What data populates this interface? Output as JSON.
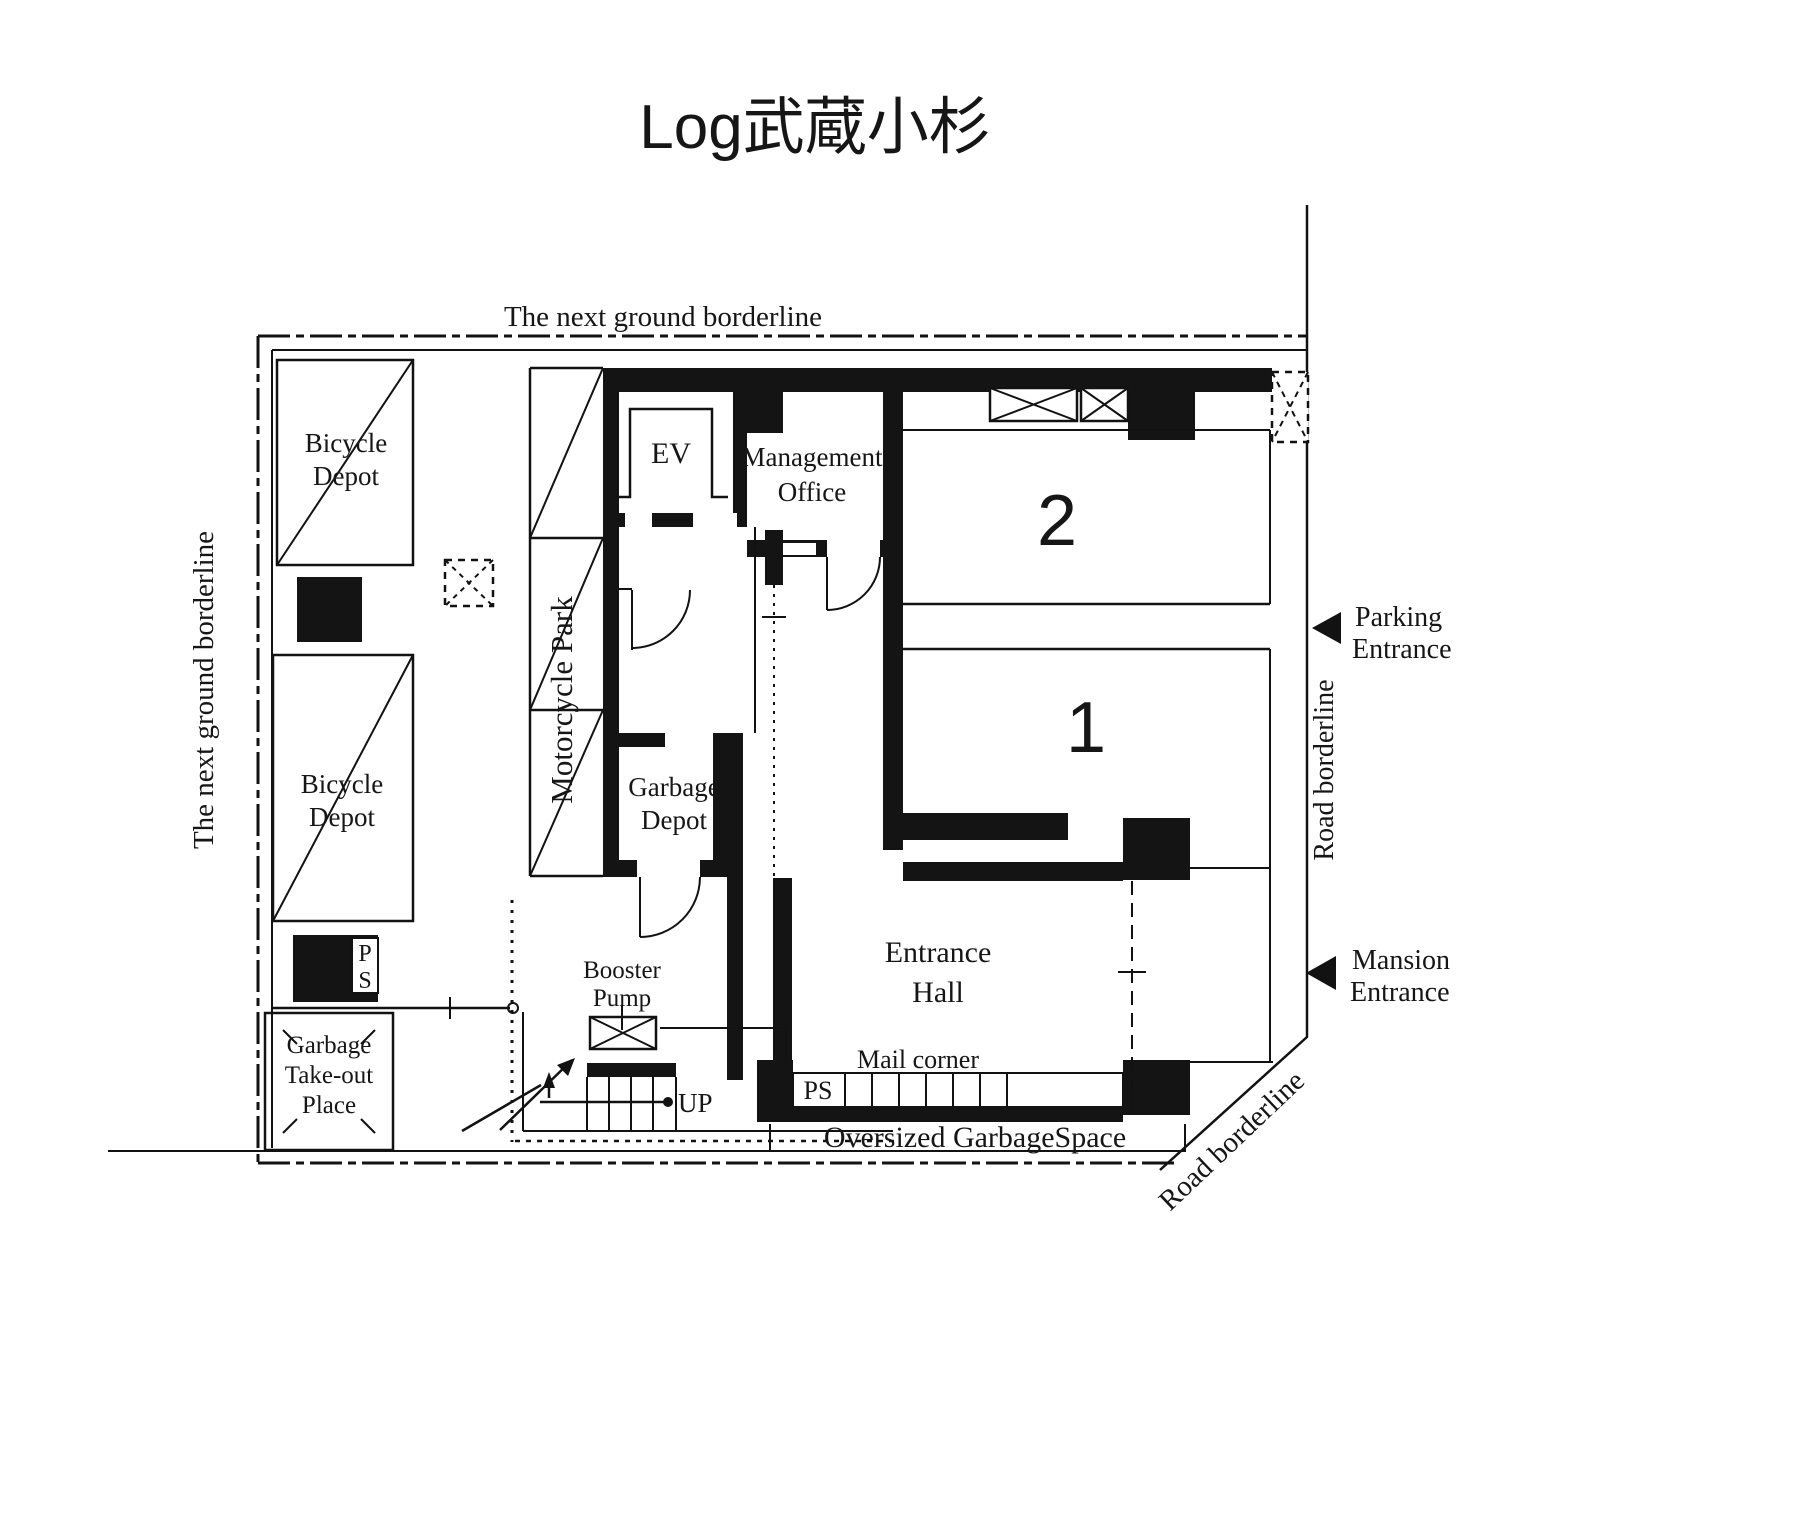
{
  "title": "Log武蔵小杉",
  "colors": {
    "ink": "#141414",
    "paper": "#ffffff"
  },
  "boundaries": {
    "top": "The next ground borderline",
    "left": "The next ground borderline",
    "right": "Road borderline",
    "diag": "Road borderline"
  },
  "entrances": {
    "parking": {
      "l1": "Parking",
      "l2": "Entrance"
    },
    "mansion": {
      "l1": "Mansion",
      "l2": "Entrance"
    }
  },
  "rooms": {
    "bicycle_depot_1": {
      "l1": "Bicycle",
      "l2": "Depot"
    },
    "bicycle_depot_2": {
      "l1": "Bicycle",
      "l2": "Depot"
    },
    "motorcycle_park": "Motorcycle Park",
    "ev": "EV",
    "management_office": {
      "l1": "Management",
      "l2": "Office"
    },
    "garbage_depot": {
      "l1": "Garbage",
      "l2": "Depot"
    },
    "entrance_hall": {
      "l1": "Entrance",
      "l2": "Hall"
    },
    "booster_pump": {
      "l1": "Booster",
      "l2": "Pump"
    },
    "garbage_takeout": {
      "l1": "Garbage",
      "l2": "Take-out",
      "l3": "Place"
    },
    "mail_corner": "Mail corner",
    "oversized_garbage": "Oversized GarbageSpace"
  },
  "markers": {
    "space_2": "2",
    "space_1": "1",
    "up": "UP",
    "ps_mail": "PS",
    "ps_shaft": {
      "l1": "P",
      "l2": "S"
    }
  }
}
